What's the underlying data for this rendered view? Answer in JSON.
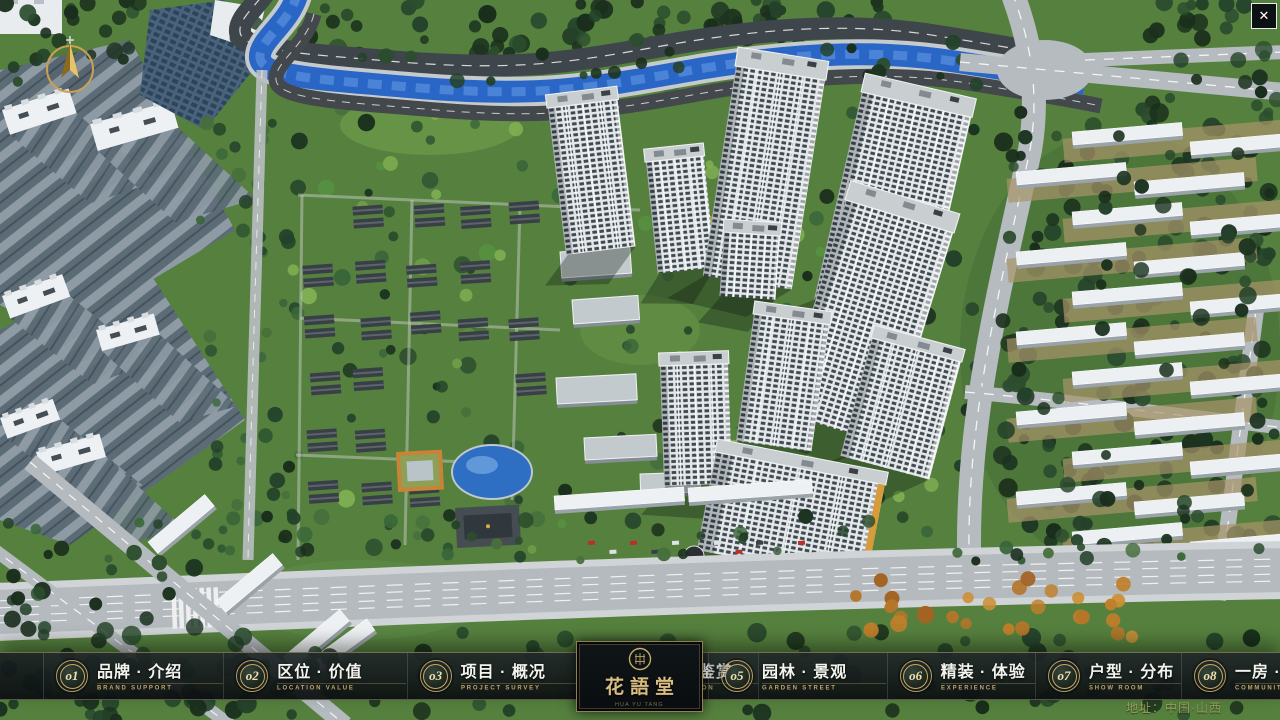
{
  "window": {
    "close_label": "✕"
  },
  "logo": {
    "name": "花語堂",
    "subtitle": "HUA YU TANG"
  },
  "footer": {
    "address": "地址：中国·山西"
  },
  "nav": {
    "items_left": [
      {
        "num": "o1",
        "title": "品牌 · 介绍",
        "subtitle": "BRAND SUPPORT"
      },
      {
        "num": "o2",
        "title": "区位 · 价值",
        "subtitle": "LOCATION VALUE"
      },
      {
        "num": "o3",
        "title": "项目 · 概况",
        "subtitle": "PROJECT SURVEY"
      },
      {
        "num": "o4",
        "title": "建筑 · 鉴赏",
        "subtitle": "APPRECIATION"
      }
    ],
    "items_right": [
      {
        "num": "o5",
        "title": "园林 · 景观",
        "subtitle": "GARDEN STREET"
      },
      {
        "num": "o6",
        "title": "精装 · 体验",
        "subtitle": "EXPERIENCE"
      },
      {
        "num": "o7",
        "title": "户型 · 分布",
        "subtitle": "SHOW ROOM"
      },
      {
        "num": "o8",
        "title": "一房 · 一景",
        "subtitle": "COMMUNITY"
      }
    ]
  },
  "colors": {
    "gold": "#bfa56b",
    "bar_bg": "#141a1e",
    "river": "#2a66c6",
    "grass": "#56803e"
  }
}
